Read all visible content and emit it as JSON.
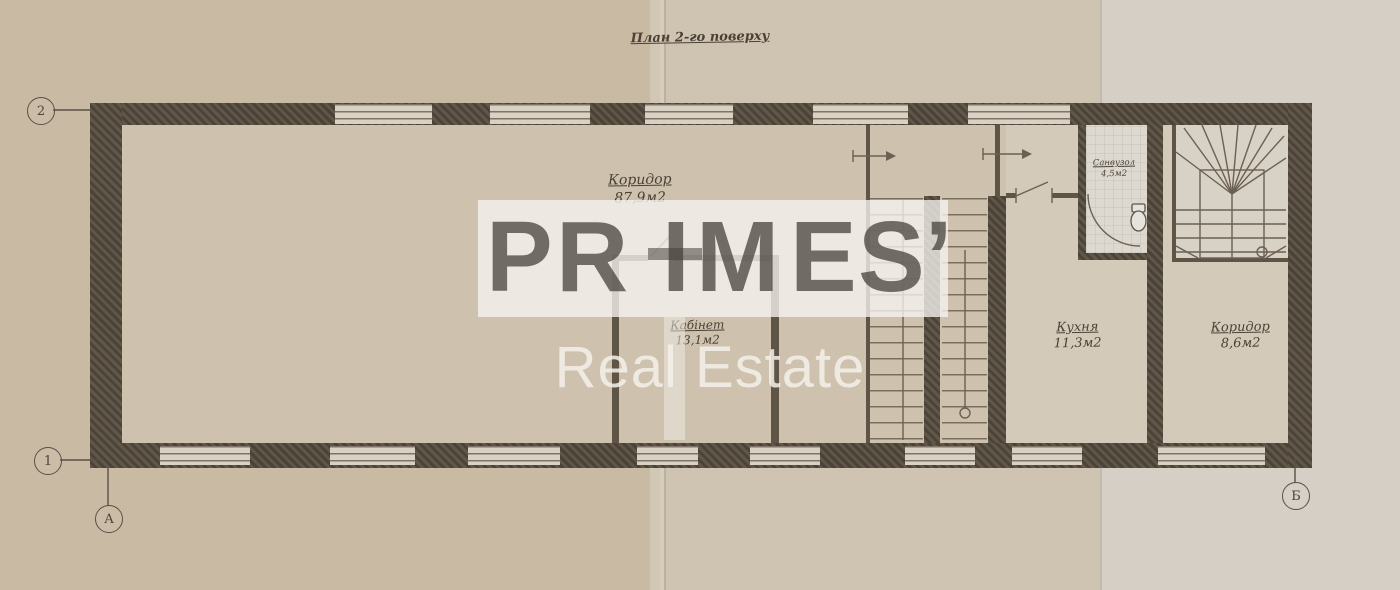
{
  "title": "План 2-го поверху",
  "watermark": {
    "letters": [
      "P",
      "R",
      "I",
      "M",
      "E",
      "S’"
    ],
    "tagline": "Real Estate"
  },
  "axes": {
    "top_left": "2",
    "bottom_left": "1",
    "bottom_a": "А",
    "bottom_b": "Б"
  },
  "rooms": {
    "corridor_main": {
      "name": "Коридор",
      "area": "87,9м2"
    },
    "cabinet": {
      "name": "Кабінет",
      "area": "13,1м2"
    },
    "kitchen": {
      "name": "Кухня",
      "area": "11,3м2"
    },
    "bathroom": {
      "name": "Санвузол",
      "area": "4,5м2"
    },
    "corridor_right": {
      "name": "Коридор",
      "area": "8,6м2"
    }
  },
  "colors": {
    "wall": "#564c3f",
    "paper": "#c9baa4",
    "watermark_band": "#f6f4f0"
  }
}
